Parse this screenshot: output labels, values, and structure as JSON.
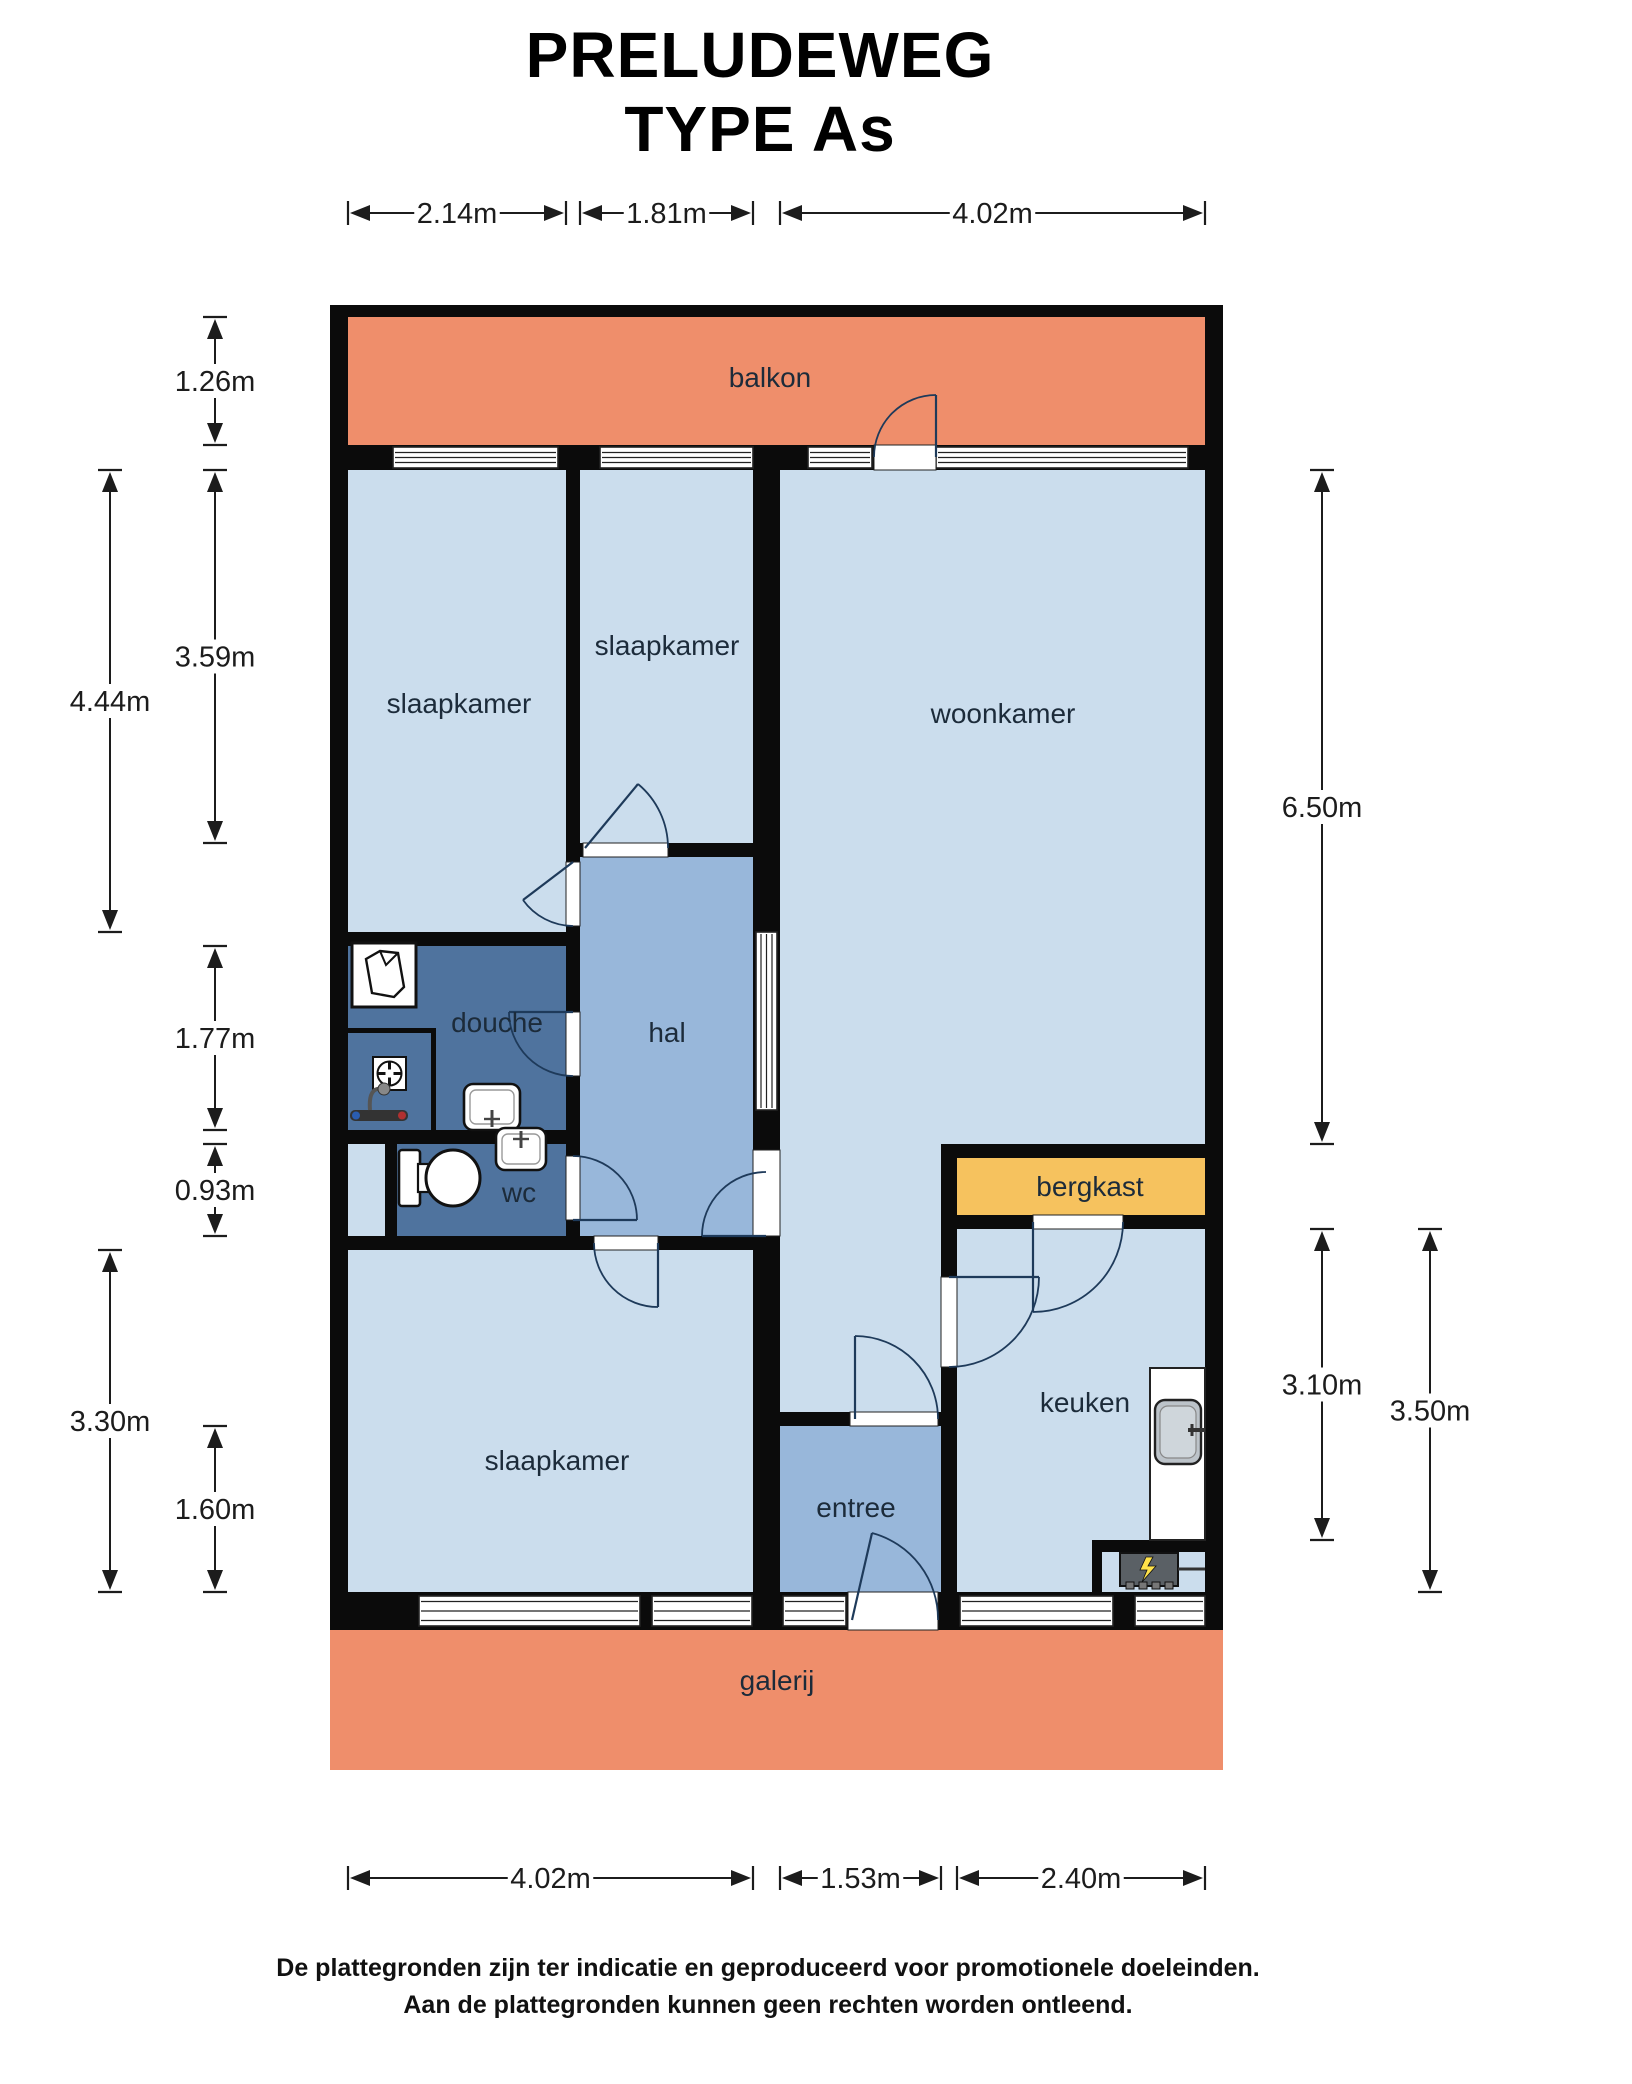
{
  "title": {
    "line1": "PRELUDEWEG",
    "line2": "TYPE As"
  },
  "footer": {
    "line1": "De plattegronden zijn ter indicatie en geproduceerd voor promotionele doeleinden.",
    "line2": "Aan de plattegronden kunnen geen rechten worden ontleend."
  },
  "colors": {
    "wall": "#0b0b0b",
    "salmon": "#ef8e6b",
    "light": "#cbdded",
    "medium": "#98b7da",
    "dark": "#4f739e",
    "orange": "#f6c25e",
    "arc": "#1e3a5a",
    "label": "#1c2b3a",
    "dim": "#1c1c1c",
    "white": "#ffffff",
    "frame": "#222222",
    "counter": "#ffffff",
    "sink": "#bcc3c9",
    "stove": "#5a6065",
    "bolt": "#ffe24a"
  },
  "floorplan": {
    "rooms": [
      {
        "id": "balkon",
        "label": "balkon",
        "path": "M348 317 H1205 V445 H348 Z",
        "fill": "salmon",
        "lx": 770,
        "ly": 387
      },
      {
        "id": "galerij",
        "label": "galerij",
        "path": "M330 1630 H1223 V1770 H330 Z",
        "fill": "salmon",
        "lx": 777,
        "ly": 1690
      },
      {
        "id": "slaapkamer-links",
        "label": "slaapkamer",
        "path": "M348 470 H566 V932 H348 Z",
        "fill": "light",
        "lx": 459,
        "ly": 713
      },
      {
        "id": "slaapkamer-midden",
        "label": "slaapkamer",
        "path": "M580 470 H753 V843 H580 Z",
        "fill": "light",
        "lx": 667,
        "ly": 655
      },
      {
        "id": "woonkamer",
        "label": "woonkamer",
        "path": "M780 470 H1205 V1144 H941 V1412 H780 Z",
        "fill": "light",
        "lx": 1003,
        "ly": 723
      },
      {
        "id": "hal",
        "label": "hal",
        "path": "M580 857 H753 V1236 H580 Z",
        "fill": "medium",
        "lx": 667,
        "ly": 1042
      },
      {
        "id": "douche",
        "label": "douche",
        "path": "M348 946 H566 V1130 H348 Z",
        "fill": "dark",
        "lx": 497,
        "ly": 1032
      },
      {
        "id": "wc",
        "label": "wc",
        "path": "M397 1144 H566 V1236 H397 Z",
        "fill": "dark",
        "lx": 519,
        "ly": 1202
      },
      {
        "id": "leiding-niche",
        "label": "",
        "path": "M348 1144 H385 V1236 H348 Z",
        "fill": "light",
        "lx": 0,
        "ly": 0
      },
      {
        "id": "slaapkamer-onder",
        "label": "slaapkamer",
        "path": "M348 1250 H753 V1592 H348 Z",
        "fill": "light",
        "lx": 557,
        "ly": 1470
      },
      {
        "id": "entree",
        "label": "entree",
        "path": "M780 1426 H941 V1592 H780 Z",
        "fill": "medium",
        "lx": 856,
        "ly": 1517
      },
      {
        "id": "keuken",
        "label": "keuken",
        "path": "M957 1229 H1205 V1592 H957 Z",
        "fill": "light",
        "lx": 1085,
        "ly": 1412
      },
      {
        "id": "bergkast",
        "label": "bergkast",
        "path": "M957 1158 H1205 V1215 H957 Z",
        "fill": "orange",
        "lx": 1090,
        "ly": 1196
      }
    ],
    "walls": [
      [
        330,
        305,
        18,
        1325
      ],
      [
        1205,
        305,
        18,
        1325
      ],
      [
        330,
        305,
        893,
        12
      ],
      [
        330,
        445,
        893,
        25
      ],
      [
        330,
        1592,
        893,
        38
      ],
      [
        566,
        470,
        14,
        392
      ],
      [
        566,
        926,
        14,
        86
      ],
      [
        566,
        1076,
        14,
        80
      ],
      [
        566,
        1220,
        14,
        16
      ],
      [
        348,
        932,
        232,
        14
      ],
      [
        753,
        470,
        27,
        462
      ],
      [
        753,
        932,
        27,
        178
      ],
      [
        753,
        1110,
        27,
        40
      ],
      [
        753,
        1236,
        27,
        356
      ],
      [
        566,
        843,
        17,
        14
      ],
      [
        668,
        843,
        85,
        14
      ],
      [
        348,
        1130,
        232,
        14
      ],
      [
        385,
        1144,
        12,
        92
      ],
      [
        330,
        1236,
        264,
        14
      ],
      [
        658,
        1236,
        122,
        14
      ],
      [
        780,
        1412,
        70,
        14
      ],
      [
        938,
        1412,
        19,
        14
      ],
      [
        941,
        1144,
        16,
        133
      ],
      [
        941,
        1367,
        16,
        225
      ],
      [
        941,
        1144,
        264,
        14
      ],
      [
        941,
        1215,
        92,
        14
      ],
      [
        1123,
        1215,
        82,
        14
      ],
      [
        348,
        1028,
        88,
        5
      ],
      [
        431,
        1028,
        5,
        102
      ],
      [
        1092,
        1540,
        113,
        12
      ],
      [
        1092,
        1540,
        10,
        52
      ]
    ],
    "windows_h": [
      [
        393,
        447,
        165,
        21
      ],
      [
        600,
        447,
        153,
        21
      ],
      [
        808,
        447,
        64,
        21
      ],
      [
        936,
        447,
        252,
        21
      ],
      [
        419,
        1596,
        221,
        30
      ],
      [
        652,
        1596,
        100,
        30
      ],
      [
        783,
        1596,
        63,
        30
      ],
      [
        960,
        1596,
        153,
        30
      ],
      [
        1135,
        1596,
        70,
        30
      ]
    ],
    "glass_panels_v": [
      [
        756,
        932,
        21,
        178
      ]
    ],
    "door_openings": [
      [
        874,
        445,
        62,
        25
      ],
      [
        566,
        862,
        14,
        64
      ],
      [
        583,
        843,
        85,
        14
      ],
      [
        566,
        1012,
        14,
        64
      ],
      [
        566,
        1156,
        14,
        64
      ],
      [
        753,
        1150,
        27,
        86
      ],
      [
        594,
        1236,
        64,
        14
      ],
      [
        850,
        1412,
        88,
        14
      ],
      [
        941,
        1277,
        16,
        90
      ],
      [
        1033,
        1215,
        90,
        14
      ],
      [
        848,
        1592,
        90,
        38
      ]
    ],
    "doors": [
      {
        "id": "balkon-deur",
        "leaf": "M 936 457 L 936 395",
        "arc": "M 936 395 A 62 62 0 0 0 874 457"
      },
      {
        "id": "slaapkamer-links-deur",
        "leaf": "M 573 862 L 523 900",
        "arc": "M 523 900 A 62 62 0 0 0 573 926"
      },
      {
        "id": "slaapkamer-midden-deur",
        "leaf": "M 585 848 L 638 784",
        "arc": "M 638 784 A 83 83 0 0 1 668 848"
      },
      {
        "id": "douche-deur",
        "leaf": "M 573 1012 L 509 1012",
        "arc": "M 509 1012 A 64 64 0 0 0 573 1076"
      },
      {
        "id": "wc-deur",
        "leaf": "M 573 1220 L 637 1220",
        "arc": "M 637 1220 A 64 64 0 0 0 573 1156"
      },
      {
        "id": "hal-woonkamer-deur",
        "leaf": "M 766 1236 L 702 1236",
        "arc": "M 702 1236 A 64 64 0 0 1 766 1172"
      },
      {
        "id": "slaapkamer-onder-deur",
        "leaf": "M 658 1243 L 658 1307",
        "arc": "M 658 1307 A 64 64 0 0 1 594 1243"
      },
      {
        "id": "entree-deur",
        "leaf": "M 855 1419 L 855 1336",
        "arc": "M 855 1336 A 83 83 0 0 1 938 1419"
      },
      {
        "id": "keuken-deur",
        "leaf": "M 949 1277 L 1039 1277",
        "arc": "M 1039 1277 A 90 90 0 0 1 949 1367"
      },
      {
        "id": "bergkast-deur",
        "leaf": "M 1033 1222 L 1033 1312",
        "arc": "M 1033 1312 A 90 90 0 0 0 1123 1222"
      },
      {
        "id": "voordeur",
        "leaf": "M 852 1620 L 872 1533",
        "arc": "M 872 1533 A 89 89 0 0 1 938 1620"
      }
    ],
    "dimensions": [
      {
        "dir": "h",
        "x1": 348,
        "x2": 566,
        "y": 213,
        "label": "2.14m"
      },
      {
        "dir": "h",
        "x1": 580,
        "x2": 753,
        "y": 213,
        "label": "1.81m"
      },
      {
        "dir": "h",
        "x1": 780,
        "x2": 1205,
        "y": 213,
        "label": "4.02m"
      },
      {
        "dir": "h",
        "x1": 348,
        "x2": 753,
        "y": 1878,
        "label": "4.02m"
      },
      {
        "dir": "h",
        "x1": 780,
        "x2": 941,
        "y": 1878,
        "label": "1.53m"
      },
      {
        "dir": "h",
        "x1": 957,
        "x2": 1205,
        "y": 1878,
        "label": "2.40m"
      },
      {
        "dir": "v",
        "y1": 470,
        "y2": 932,
        "x": 110,
        "label": "4.44m"
      },
      {
        "dir": "v",
        "y1": 1250,
        "y2": 1592,
        "x": 110,
        "label": "3.30m"
      },
      {
        "dir": "v",
        "y1": 317,
        "y2": 445,
        "x": 215,
        "label": "1.26m"
      },
      {
        "dir": "v",
        "y1": 470,
        "y2": 843,
        "x": 215,
        "label": "3.59m"
      },
      {
        "dir": "v",
        "y1": 946,
        "y2": 1130,
        "x": 215,
        "label": "1.77m"
      },
      {
        "dir": "v",
        "y1": 1144,
        "y2": 1236,
        "x": 215,
        "label": "0.93m"
      },
      {
        "dir": "v",
        "y1": 1426,
        "y2": 1592,
        "x": 215,
        "label": "1.60m"
      },
      {
        "dir": "v",
        "y1": 470,
        "y2": 1144,
        "x": 1322,
        "label": "6.50m"
      },
      {
        "dir": "v",
        "y1": 1229,
        "y2": 1540,
        "x": 1322,
        "label": "3.10m"
      },
      {
        "dir": "v",
        "y1": 1229,
        "y2": 1592,
        "x": 1430,
        "label": "3.50m"
      }
    ],
    "fixtures": [
      {
        "type": "washer",
        "x": 352,
        "y": 943
      },
      {
        "type": "fan",
        "x": 373,
        "y": 1057
      },
      {
        "type": "mixer",
        "x": 350,
        "y": 1110
      },
      {
        "type": "basin",
        "x": 464,
        "y": 1084,
        "w": 56,
        "h": 46,
        "tap": "bottom"
      },
      {
        "type": "basin",
        "x": 496,
        "y": 1128,
        "w": 50,
        "h": 42,
        "tap": "top"
      },
      {
        "type": "toilet",
        "x": 399,
        "y": 1150
      },
      {
        "type": "counter",
        "x": 1150,
        "y": 1368,
        "w": 55,
        "h": 172
      },
      {
        "type": "ksink",
        "x": 1155,
        "y": 1400
      },
      {
        "type": "stove",
        "x": 1120,
        "y": 1553
      }
    ]
  }
}
